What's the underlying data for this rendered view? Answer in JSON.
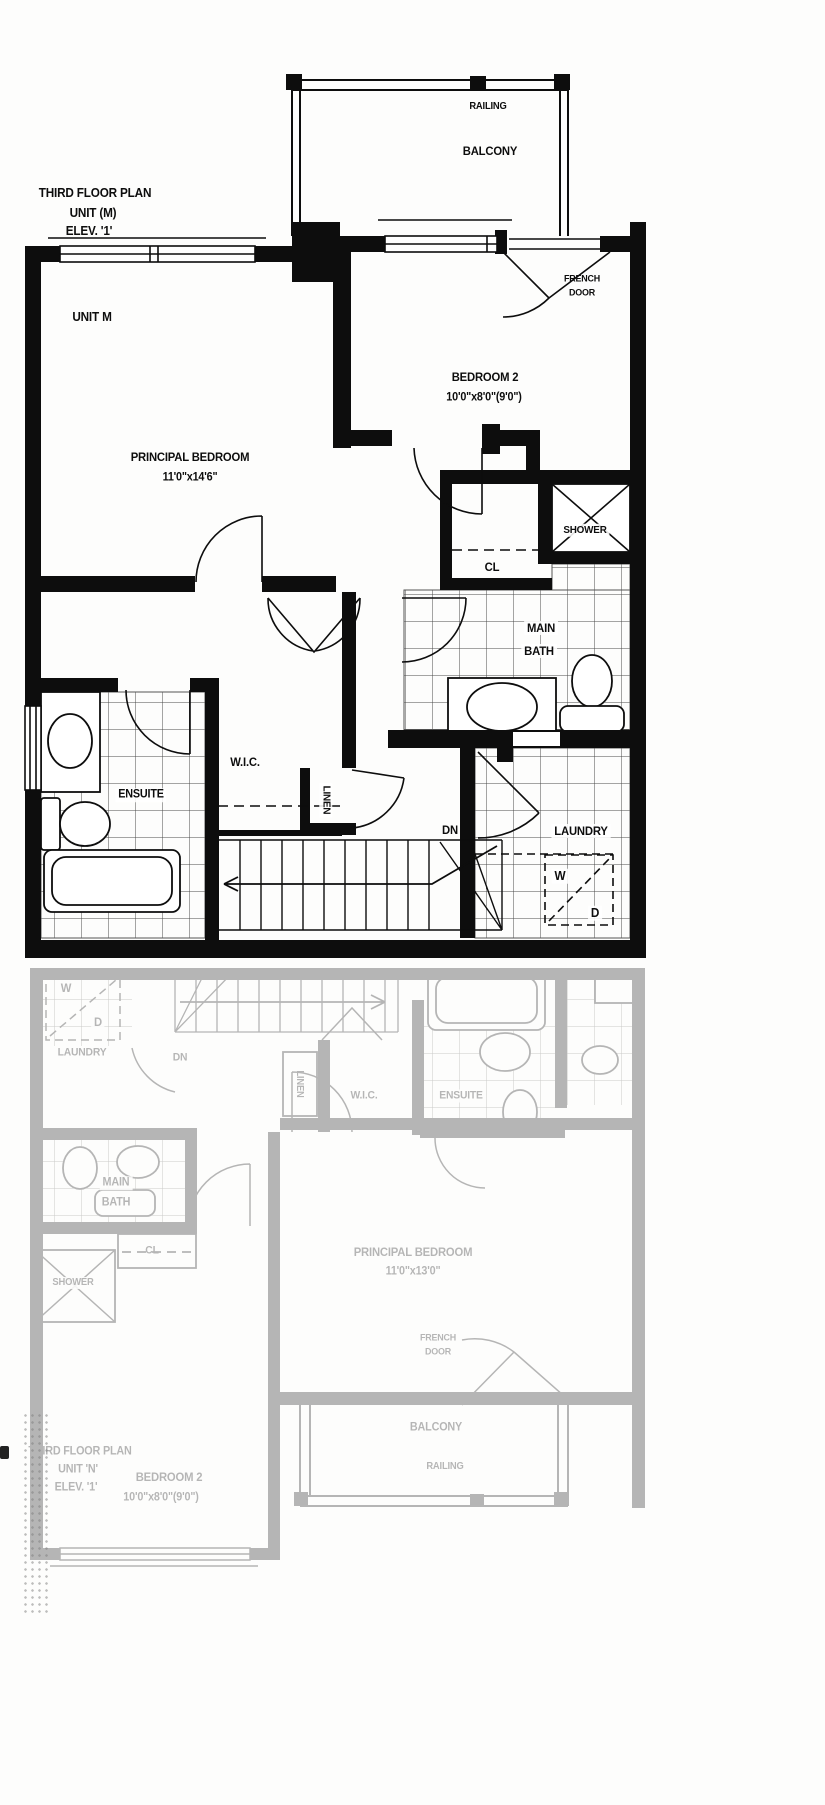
{
  "page": {
    "background": "#fdfdfc",
    "ink_color": "#0d0d0d",
    "faded_ink_color": "#9b9b9b"
  },
  "top_plan": {
    "title": {
      "line1": "THIRD FLOOR PLAN",
      "line2": "UNIT (M)",
      "line3": "ELEV. '1'"
    },
    "labels": {
      "railing": "RAILING",
      "balcony": "BALCONY",
      "unit": "UNIT M",
      "french_door_line1": "FRENCH",
      "french_door_line2": "DOOR",
      "bedroom2_name": "BEDROOM 2",
      "bedroom2_dims": "10'0\"x8'0\"(9'0\")",
      "principal_name": "PRINCIPAL BEDROOM",
      "principal_dims": "11'0\"x14'6\"",
      "shower": "SHOWER",
      "closet": "CL",
      "main_bath_line1": "MAIN",
      "main_bath_line2": "BATH",
      "ensuite": "ENSUITE",
      "wic": "W.I.C.",
      "linen": "LINEN",
      "down": "DN",
      "laundry": "LAUNDRY",
      "washer": "W",
      "dryer": "D"
    }
  },
  "bottom_plan": {
    "title": {
      "line1": "THIRD FLOOR PLAN",
      "line2": "UNIT 'N'",
      "line3": "ELEV. '1'"
    },
    "labels": {
      "railing": "RAILING",
      "balcony": "BALCONY",
      "french_door_line1": "FRENCH",
      "french_door_line2": "DOOR",
      "bedroom2_name": "BEDROOM 2",
      "bedroom2_dims": "10'0\"x8'0\"(9'0\")",
      "principal_name": "PRINCIPAL BEDROOM",
      "principal_dims": "11'0\"x13'0\"",
      "shower": "SHOWER",
      "closet": "CL",
      "main_bath_line1": "MAIN",
      "main_bath_line2": "BATH",
      "ensuite": "ENSUITE",
      "wic": "W.I.C.",
      "linen": "LINEN",
      "down": "DN",
      "laundry": "LAUNDRY",
      "washer": "W",
      "dryer": "D"
    }
  }
}
